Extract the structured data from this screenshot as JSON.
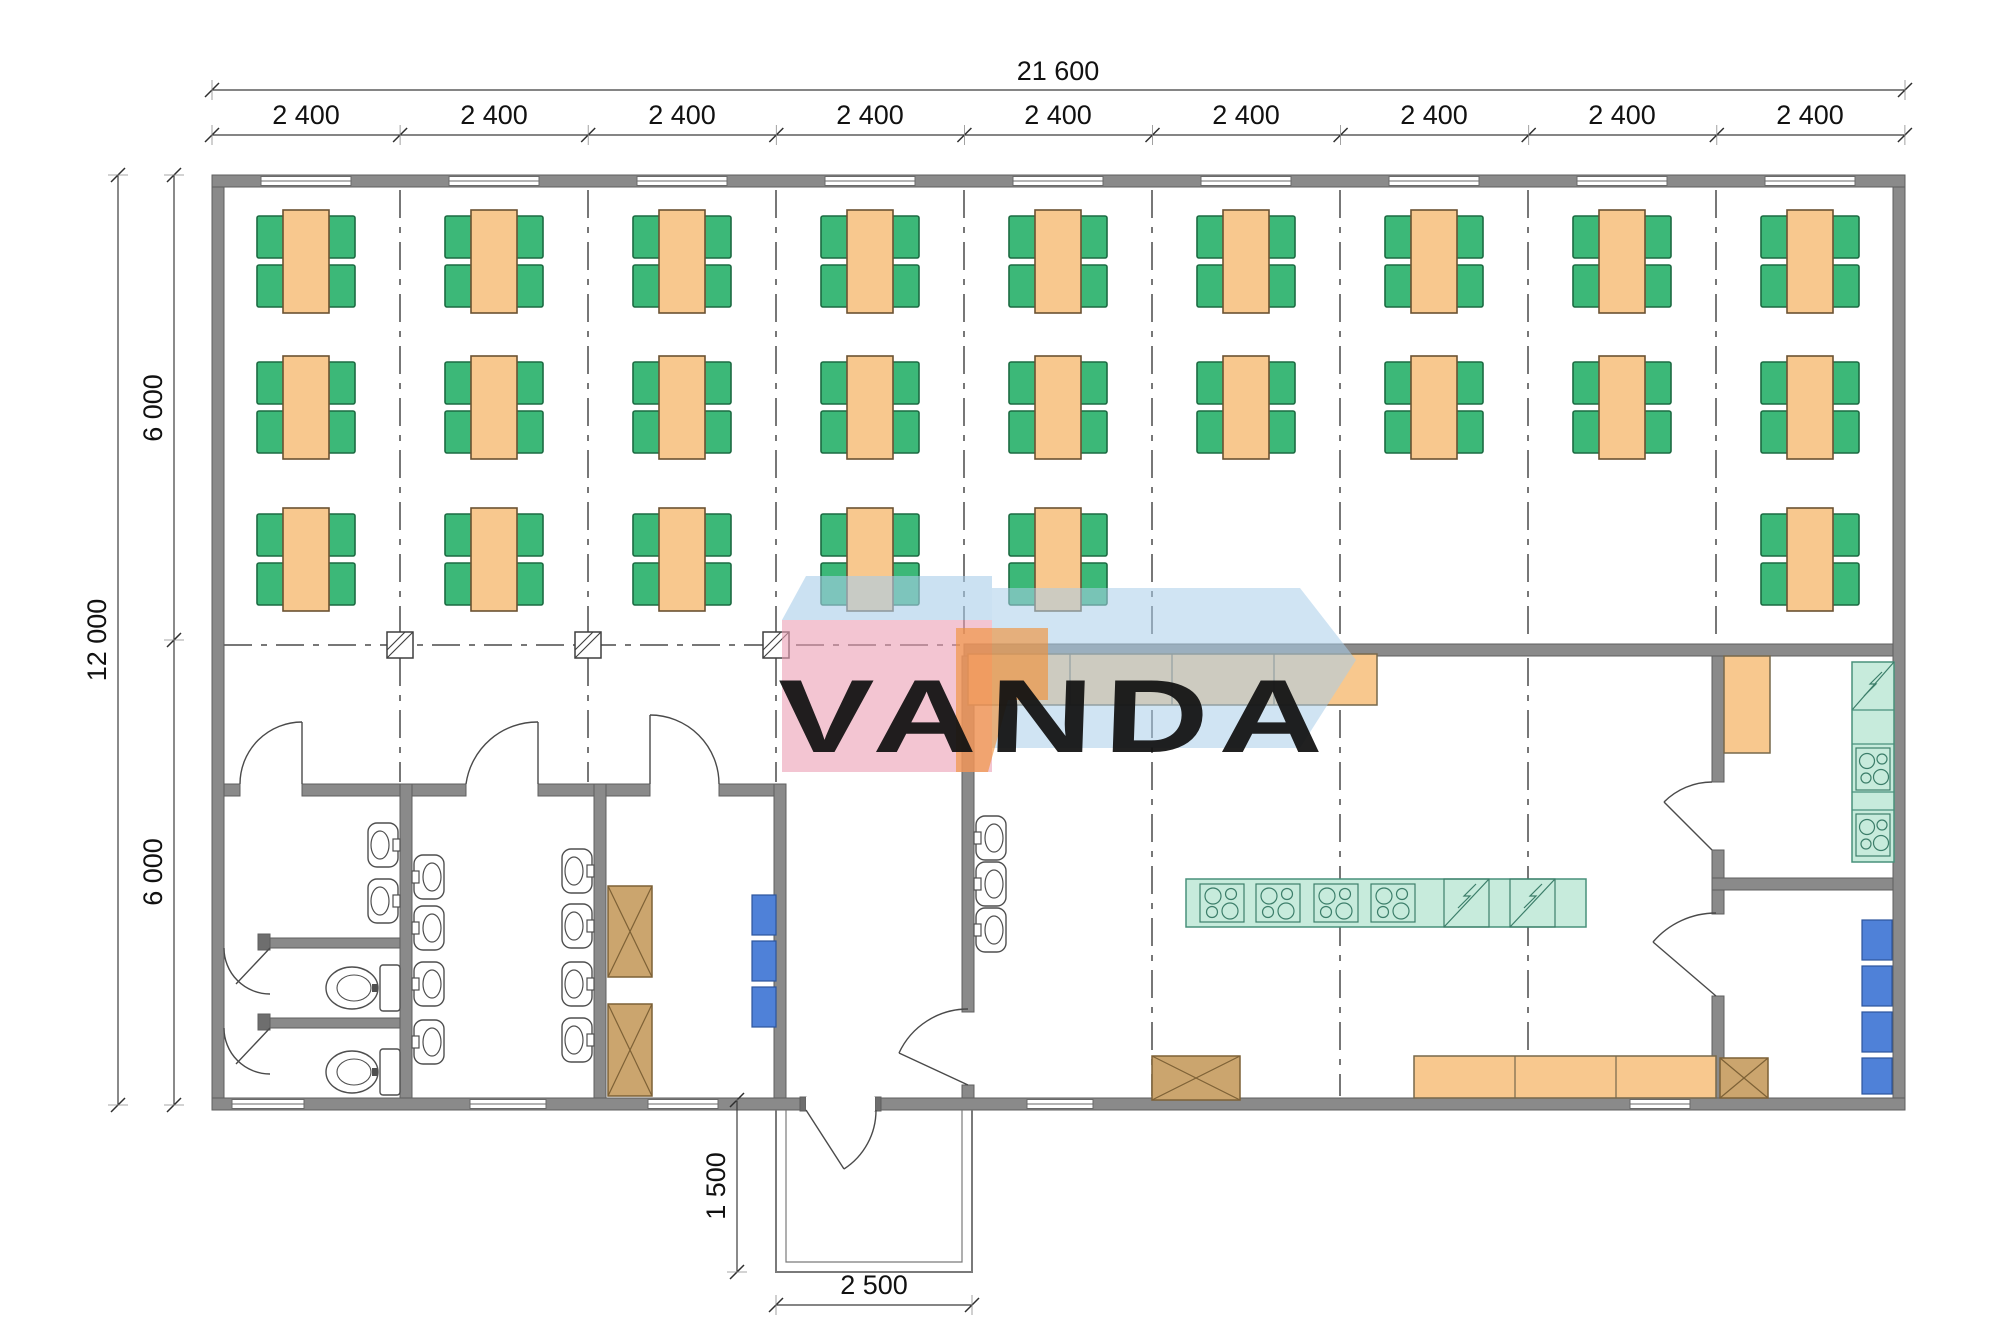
{
  "drawing": {
    "type": "architectural-floor-plan",
    "watermark": {
      "text": "VANDA",
      "pink": "#eb9fb4",
      "blue": "#a9cdea",
      "orange": "#f0923c",
      "text_color": "#ffffff"
    },
    "dimensions": {
      "overall_width_mm": "21 600",
      "bay_widths_mm": [
        "2 400",
        "2 400",
        "2 400",
        "2 400",
        "2 400",
        "2 400",
        "2 400",
        "2 400",
        "2 400"
      ],
      "overall_depth_mm": "12 000",
      "depth_segments_mm": [
        "6 000",
        "6 000"
      ],
      "porch_depth_mm": "1 500",
      "porch_width_mm": "2 500"
    },
    "colors": {
      "wall": "#8a8a8a",
      "table": "#f8c88e",
      "chair": "#3cb878",
      "counter": "#f8c88e",
      "equipment_teal": "#c7ebdc",
      "storage_brown": "#cba56e",
      "unit_blue": "#4f81d8",
      "grid_line": "#4a4a4a"
    },
    "furniture": {
      "dining_table_count": 24,
      "chairs_per_table": 4,
      "chair_count": 96
    },
    "fixtures": {
      "wash_basins": 13,
      "toilets": 2,
      "toilet_stalls": 2,
      "stove_units": 6,
      "sink_units": 3,
      "crate_boxes": 4,
      "blue_units": 7,
      "windows_top": 9,
      "windows_bottom": 5,
      "column_markers": 3
    }
  }
}
